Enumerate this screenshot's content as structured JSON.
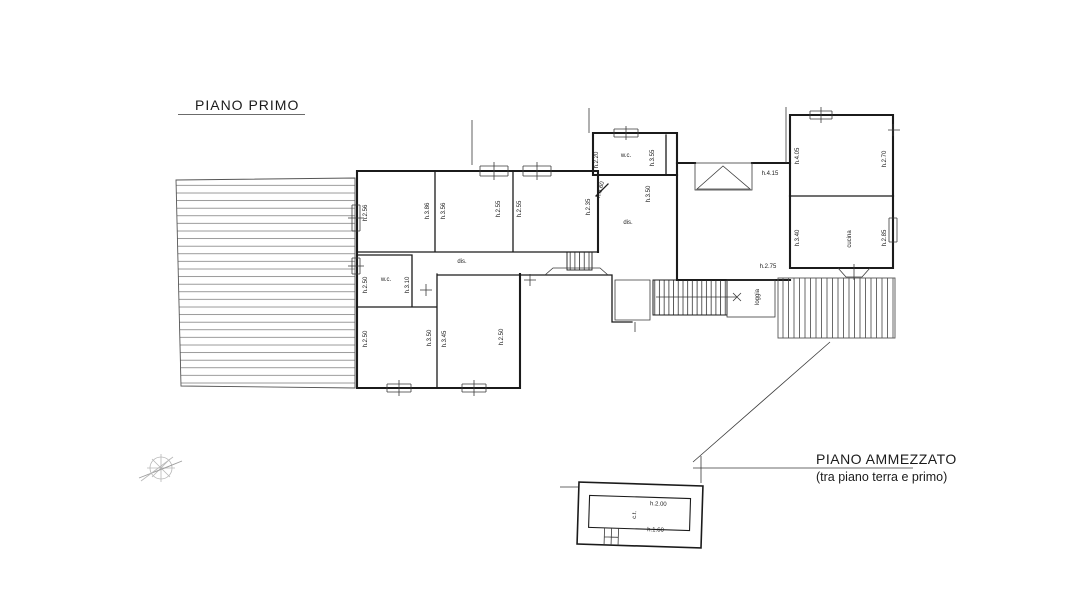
{
  "titles": {
    "first_floor": "PIANO PRIMO",
    "mezzanine": "PIANO AMMEZZATO",
    "mezzanine_sub": "(tra piano terra e primo)"
  },
  "icons": {
    "north_arrow": "compass-north-arrow-icon"
  },
  "colors": {
    "line": "#1b1b1b",
    "hatch": "#6f6f6f",
    "label": "#222222",
    "compass": "#b8b8b8",
    "background": "#ffffff"
  },
  "labels": {
    "first_floor": [
      {
        "text": "h.2.56",
        "x": 367,
        "y": 213,
        "r": -90
      },
      {
        "text": "h.3.86",
        "x": 429,
        "y": 211,
        "r": -90
      },
      {
        "text": "h.3.56",
        "x": 445,
        "y": 211,
        "r": -90
      },
      {
        "text": "h.2.55",
        "x": 500,
        "y": 209,
        "r": -90
      },
      {
        "text": "h.2.55",
        "x": 521,
        "y": 209,
        "r": -90
      },
      {
        "text": "h.2.35",
        "x": 590,
        "y": 207,
        "r": -90
      },
      {
        "text": "h.3.60",
        "x": 602,
        "y": 190,
        "r": -75
      },
      {
        "text": "h.2.20",
        "x": 598,
        "y": 160,
        "r": -90
      },
      {
        "text": "w.c.",
        "x": 626,
        "y": 157,
        "r": 0
      },
      {
        "text": "h.3.55",
        "x": 654,
        "y": 158,
        "r": -90
      },
      {
        "text": "h.3.50",
        "x": 650,
        "y": 194,
        "r": -90
      },
      {
        "text": "dis.",
        "x": 628,
        "y": 224,
        "r": 0
      },
      {
        "text": "h.4.15",
        "x": 770,
        "y": 175,
        "r": 0
      },
      {
        "text": "h.4.05",
        "x": 799,
        "y": 156,
        "r": -90
      },
      {
        "text": "h.2.70",
        "x": 886,
        "y": 159,
        "r": -90
      },
      {
        "text": "h.3.40",
        "x": 799,
        "y": 238,
        "r": -90
      },
      {
        "text": "cucina",
        "x": 851,
        "y": 239,
        "r": -90
      },
      {
        "text": "h.2.85",
        "x": 886,
        "y": 238,
        "r": -90
      },
      {
        "text": "h.2.75",
        "x": 768,
        "y": 268,
        "r": 0
      },
      {
        "text": "loggia",
        "x": 759,
        "y": 297,
        "r": -90
      },
      {
        "text": "w.c.",
        "x": 386,
        "y": 281,
        "r": 0
      },
      {
        "text": "h.3.10",
        "x": 409,
        "y": 285,
        "r": -90
      },
      {
        "text": "h.2.50",
        "x": 367,
        "y": 285,
        "r": -90
      },
      {
        "text": "dis.",
        "x": 462,
        "y": 263,
        "r": 0
      },
      {
        "text": "h.2.50",
        "x": 367,
        "y": 339,
        "r": -90
      },
      {
        "text": "h.3.50",
        "x": 431,
        "y": 338,
        "r": -90
      },
      {
        "text": "h.3.45",
        "x": 446,
        "y": 339,
        "r": -90
      },
      {
        "text": "h.2.50",
        "x": 503,
        "y": 337,
        "r": -90
      }
    ],
    "mezzanine": [
      {
        "text": "h.2.00",
        "x": 658,
        "y": 505,
        "r": 0
      },
      {
        "text": "c.t.",
        "x": 636,
        "y": 515,
        "r": -90
      },
      {
        "text": "h.1.60",
        "x": 656,
        "y": 531,
        "r": 0
      }
    ]
  }
}
